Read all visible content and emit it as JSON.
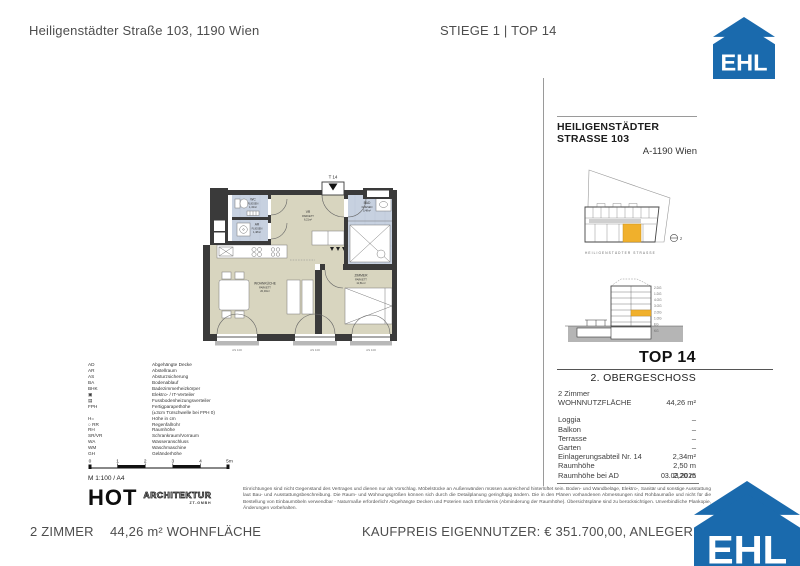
{
  "colors": {
    "accent_blue": "#1a6aad",
    "highlight_yellow": "#f0b02c",
    "parkett": "#d8d5bf",
    "fliesen": "#c7d1e0"
  },
  "header": {
    "address": "Heiligenstädter Straße 103, 1190 Wien",
    "unit": "STIEGE 1 | TOP 14"
  },
  "logo": {
    "text": "EHL"
  },
  "sidebar": {
    "title": "HEILIGENSTÄDTER STRASSE 103",
    "subtitle": "A-1190 Wien",
    "street_label": "HEILIGENSTÄDTER STRASSE",
    "north_label": "z",
    "section_floors": [
      "2.DG",
      "1.DG",
      "4.OG",
      "3.OG",
      "2.OG",
      "1.OG",
      "EG",
      "KG"
    ],
    "top_title": "TOP 14",
    "floor_label": "2. OBERGESCHOSS",
    "rooms_label": "2 Zimmer",
    "area_label": "WOHNNUTZFLÄCHE",
    "area_value": "44,26 m²",
    "details": [
      {
        "label": "Loggia",
        "value": "–"
      },
      {
        "label": "Balkon",
        "value": "–"
      },
      {
        "label": "Terrasse",
        "value": "–"
      },
      {
        "label": "Garten",
        "value": "–"
      },
      {
        "label": "Einlagerungsabteil Nr. 14",
        "value": "2,34m²"
      },
      {
        "label": "Raumhöhe",
        "value": "2,50 m"
      },
      {
        "label": "Raumhöhe bei AD",
        "value": "2,20 m"
      }
    ],
    "date": "03.03.2025"
  },
  "plan": {
    "entrance_label": "T 14",
    "rooms": [
      {
        "name": "WC",
        "floor": "FLIESEN",
        "area": "1,43m²"
      },
      {
        "name": "AR",
        "floor": "FLIESEN",
        "area": "1,48m²"
      },
      {
        "name": "VR",
        "floor": "PARKETT",
        "area": "6,21m²"
      },
      {
        "name": "BAD",
        "floor": "FLIESEN",
        "area": "5,48m²"
      },
      {
        "name": "ZIMMER",
        "floor": "PARKETT",
        "area": "11,51m²"
      },
      {
        "name": "WOHNKÜCHE",
        "floor": "PARKETT",
        "area": "20,03m²"
      }
    ],
    "window_labels": [
      "AS 100",
      "AS 100",
      "AS 100"
    ]
  },
  "legend": {
    "items": [
      {
        "abbr": "AD",
        "desc": "Abgehängte Decke"
      },
      {
        "abbr": "AR",
        "desc": "Abstellraum"
      },
      {
        "abbr": "AS",
        "desc": "Absturzsicherung"
      },
      {
        "abbr": "BA",
        "desc": "Bodenablauf"
      },
      {
        "abbr": "BHK",
        "desc": "Badezimmerheizkörper"
      },
      {
        "abbr": "▣",
        "desc": "Elektro- / IT-Verteiler"
      },
      {
        "abbr": "▤",
        "desc": "Fussbodenheizungsverteiler"
      },
      {
        "abbr": "FPH",
        "desc": "Fertigparapethöhe"
      },
      {
        "abbr": "",
        "desc": "(±3cm Türschwelle bei FPH 0)"
      },
      {
        "abbr": "H=",
        "desc": "Höhe in cm"
      },
      {
        "abbr": "○ RR",
        "desc": "Regenfallrohr"
      },
      {
        "abbr": "RH",
        "desc": "Raumhöhe"
      },
      {
        "abbr": "SR/VR",
        "desc": "Schrankraum/Vorraum"
      },
      {
        "abbr": "WA",
        "desc": "Wasseranschluss"
      },
      {
        "abbr": "WM",
        "desc": "Waschmaschine"
      },
      {
        "abbr": "GH",
        "desc": "Geländerhöhe"
      }
    ]
  },
  "scalebar": {
    "ticks": [
      "0",
      "1",
      "2",
      "3",
      "4",
      "5m"
    ],
    "note": "M 1:100 / A4"
  },
  "architect": {
    "name": "HOT",
    "field": "ARCHITEKTUR",
    "sub": "ZT-GMBH"
  },
  "disclaimer": "Einrichtungen sind nicht Gegenstand des Vertrages und dienen nur als Vorschlag. Möbelstücke an Außenwänden müssen ausreichend hinterlüftet sein. Boden- und Wandbeläge, Elektro-, Sanitär und sonstige Ausstattung laut Bau- und Ausstattungsbeschreibung. Die Raum- und Wohnungsgrößen können sich durch die Detailplanung geringfügig ändern. Die in den Plänen vorhandenen Abmessungen sind Rohbaumaße und nicht für die Bestellung von Einbaumöbeln verwendbar - Naturmaße erforderlich! Abgehängte Decken und Poterien nach Erfordernis (Abminderung der Raumhöhe). Übersichtspläne sind zu berücksichtigen. Unverbindliche Plankopie, Änderungen vorbehalten.",
  "footer": {
    "rooms": "2 ZIMMER",
    "area": "44,26 m² WOHNFLÄCHE",
    "price": "KAUFPREIS EIGENNUTZER: € 351.700,00, ANLEGER: € 32"
  }
}
